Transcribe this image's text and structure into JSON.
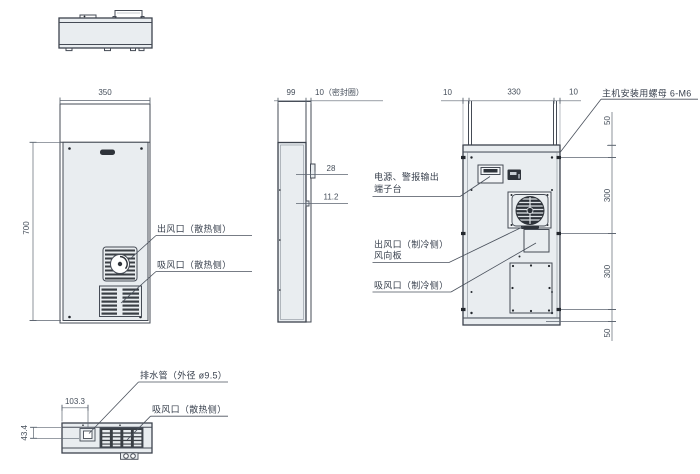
{
  "colors": {
    "panel_fill": "#e9edf0",
    "outline": "#454b55",
    "dim_line": "#5c6570",
    "text": "#39414e",
    "dark_part": "#2e333a",
    "background": "#ffffff"
  },
  "front_view": {
    "dim_width": "350",
    "dim_height": "700",
    "label_outlet": "出风口（散热侧）",
    "label_inlet": "吸风口（散热侧）"
  },
  "side_view": {
    "dim_depth": "99",
    "dim_seal": "10（密封圈）",
    "dim_terminal": "28",
    "dim_offset": "11.2"
  },
  "rear_view": {
    "dim_edge_left": "10",
    "dim_span": "330",
    "dim_edge_right": "10",
    "dim_top": "50",
    "dim_mid_upper": "300",
    "dim_mid_lower": "300",
    "dim_bottom": "50",
    "label_mounting_nut": "主机安装用螺母 6-M6",
    "label_terminal_line1": "电源、警报输出",
    "label_terminal_line2": "端子台",
    "label_outlet_line1": "出风口（制冷侧）",
    "label_outlet_line2": "风向板",
    "label_inlet": "吸风口（制冷侧）"
  },
  "bottom_view": {
    "dim_drain_x": "103.3",
    "dim_drain_y": "43.4",
    "label_drain": "排水管（外径 ø9.5）",
    "label_inlet": "吸风口（散热侧）"
  }
}
